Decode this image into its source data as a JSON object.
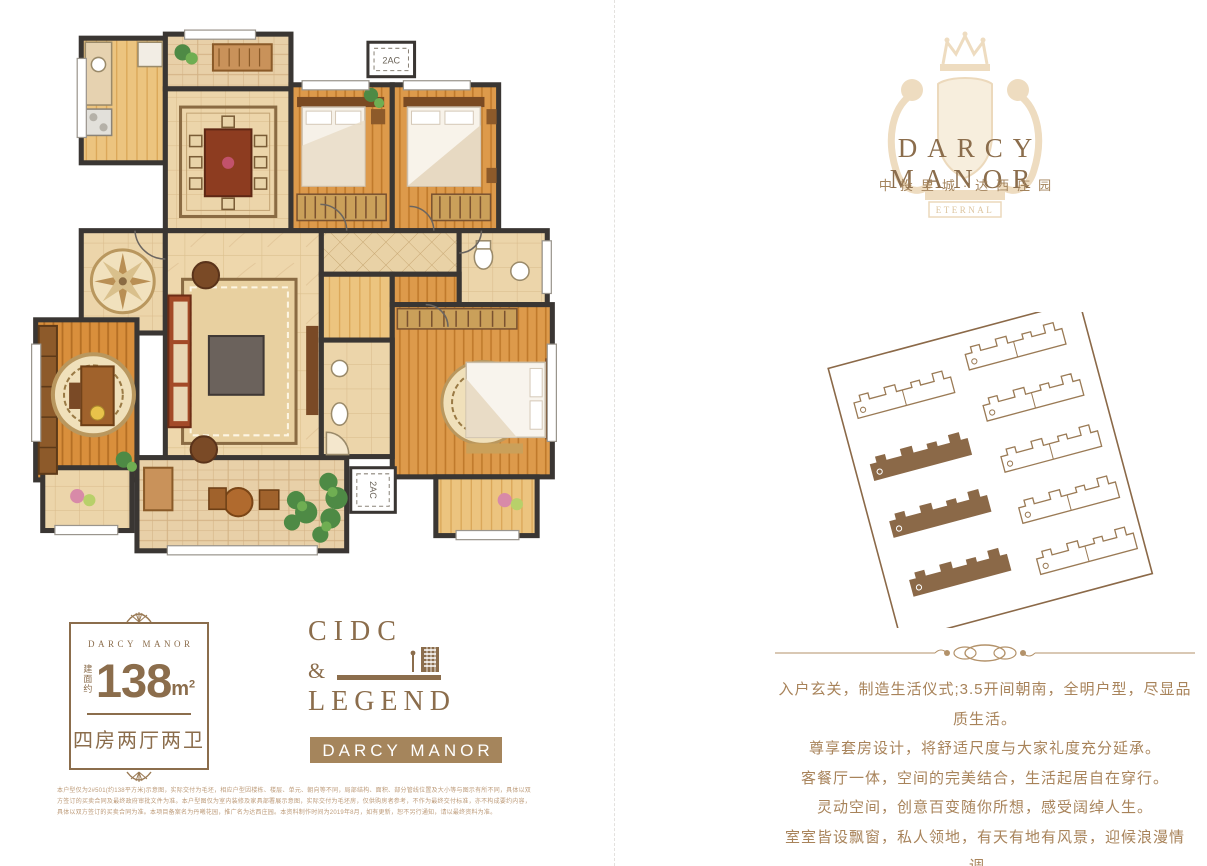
{
  "logo": {
    "title": "DARCY MANOR",
    "subtitle": "中投里城·达西庄园",
    "crest_motto": "ETERNAL"
  },
  "floor_plan": {
    "ac_label": "2AC"
  },
  "unit_card": {
    "brand": "DARCY MANOR",
    "area_prefix": "建面约",
    "area_value": "138",
    "area_unit": "m",
    "area_exponent": "2",
    "layout_text": "四房两厅两卫"
  },
  "cidc_block": {
    "word_top": "CIDC",
    "ampersand": "&",
    "word_bottom": "LEGEND",
    "ribbon_label": "DARCY MANOR"
  },
  "description": {
    "lines": [
      "入户玄关，制造生活仪式;3.5开间朝南，全明户型，尽显品质生活。",
      "尊享套房设计，将舒适尺度与大家礼度充分延承。",
      "客餐厅一体，空间的完美结合，生活起居自在穿行。",
      "灵动空间，创意百变随你所想，感受阔绰人生。",
      "室室皆设飘窗，私人领地，有天有地有风景，迎候浪漫情调。"
    ]
  },
  "disclaimer": {
    "text": "本户型仅为2#501(约138平方米)示意图，实际交付为毛坯，相应户型因楼栋、楼层、单元、朝向等不同，局部结构、面积、部分管线位置及大小等与图示有所不同，具体以双方签订的买卖合同及最终政府审批文件为准。本户型图仅为室内装修及家具部署展示意图，实际交付为毛坯房，仅供购房者参考，不作为最终交付标准，亦不构成要约内容，具体以双方签订的买卖合同为准。本项目备案名为丹曦花园，推广名为达西庄园。本资料制作时间为2019年8月，如有更新，恕不另行通知，请以最终资料为准。"
  },
  "colors": {
    "brand_brown": "#8b6d4c",
    "body_text_brown": "#a8835a",
    "ribbon_bg": "#a5855c",
    "crest_beige": "#eedcc0",
    "wall_dark": "#3a3633",
    "wood_orange": "#dd9a4b",
    "site_outline": "#8b6948"
  }
}
